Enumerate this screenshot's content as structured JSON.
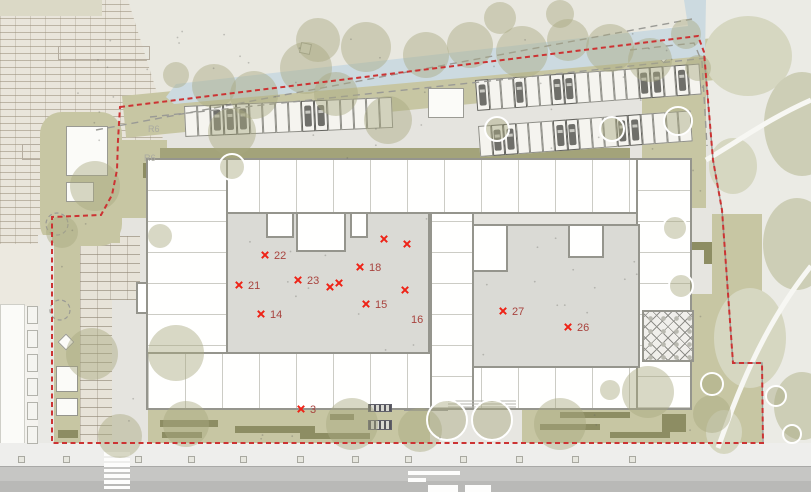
{
  "plan": {
    "room_markers": [
      {
        "label": "22",
        "x": 265,
        "y": 255
      },
      {
        "label": "21",
        "x": 239,
        "y": 285
      },
      {
        "label": "23",
        "x": 298,
        "y": 280
      },
      {
        "label": "18",
        "x": 360,
        "y": 267
      },
      {
        "label": "15",
        "x": 366,
        "y": 304
      },
      {
        "label": "14",
        "x": 261,
        "y": 314
      },
      {
        "label": "27",
        "x": 503,
        "y": 311
      },
      {
        "label": "26",
        "x": 568,
        "y": 327
      },
      {
        "label": "3",
        "x": 301,
        "y": 409
      }
    ],
    "label_only_markers": [
      {
        "label": "16",
        "x": 411,
        "y": 319
      }
    ],
    "unlabeled_markers": [
      {
        "x": 330,
        "y": 287
      },
      {
        "x": 339,
        "y": 283
      },
      {
        "x": 384,
        "y": 239
      },
      {
        "x": 407,
        "y": 244
      },
      {
        "x": 405,
        "y": 290
      }
    ],
    "grid_labels": [
      {
        "text": "R6",
        "x": 148,
        "y": 132
      },
      {
        "text": "R6",
        "x": 144,
        "y": 161
      }
    ]
  },
  "colors": {
    "boundary_red": "#cc3333",
    "marker_x": "#ee2317",
    "marker_label": "#a8433e",
    "site_ground": "#e5e4df",
    "olive_green": "#c7c6a3",
    "dark_olive": "#8d8d63",
    "facade_strip": "#a3a37a",
    "courtyard_gray": "#dadad5",
    "wall_gray": "#95958d",
    "stream_blue": "#ccdae0",
    "park_bg": "#ebebe5",
    "park_blob": "#d6d7c1",
    "park_blob2": "#cdceb6",
    "tree_canopy": "rgba(168,168,128,0.45)",
    "road_gray": "#c6c6c4",
    "road_dark": "#b9b9b7",
    "sidewalk": "#eeeeec",
    "dash_gray": "#9a9a95"
  },
  "trees": {
    "canopies": [
      [
        176,
        75,
        13
      ],
      [
        214,
        86,
        22
      ],
      [
        254,
        95,
        24
      ],
      [
        306,
        68,
        26
      ],
      [
        336,
        94,
        22
      ],
      [
        318,
        40,
        22
      ],
      [
        366,
        47,
        25
      ],
      [
        426,
        55,
        23
      ],
      [
        470,
        45,
        23
      ],
      [
        522,
        52,
        26
      ],
      [
        568,
        40,
        21
      ],
      [
        610,
        48,
        24
      ],
      [
        650,
        60,
        22
      ],
      [
        686,
        34,
        15
      ],
      [
        698,
        68,
        13
      ],
      [
        388,
        120,
        24
      ],
      [
        232,
        132,
        24
      ],
      [
        95,
        186,
        25
      ],
      [
        160,
        236,
        12
      ],
      [
        62,
        232,
        16
      ],
      [
        92,
        354,
        26
      ],
      [
        176,
        353,
        28
      ],
      [
        120,
        436,
        22
      ],
      [
        186,
        424,
        23
      ],
      [
        352,
        424,
        26
      ],
      [
        420,
        430,
        22
      ],
      [
        560,
        424,
        26
      ],
      [
        648,
        392,
        26
      ],
      [
        712,
        414,
        19
      ],
      [
        500,
        18,
        16
      ],
      [
        560,
        14,
        14
      ],
      [
        610,
        390,
        10
      ]
    ],
    "ring_trees": [
      [
        232,
        167,
        13
      ],
      [
        497,
        129,
        12
      ],
      [
        612,
        129,
        12
      ],
      [
        678,
        121,
        14
      ],
      [
        675,
        228,
        12
      ],
      [
        681,
        286,
        12
      ],
      [
        712,
        384,
        11
      ],
      [
        447,
        420,
        20
      ],
      [
        492,
        420,
        20
      ],
      [
        776,
        396,
        10
      ],
      [
        792,
        434,
        9
      ]
    ],
    "dashed_outlines": [
      [
        57,
        224,
        11
      ],
      [
        60,
        310,
        10
      ]
    ]
  },
  "park": {
    "blobs": [
      [
        748,
        56,
        44,
        40
      ],
      [
        802,
        124,
        38,
        52
      ],
      [
        733,
        166,
        24,
        28
      ],
      [
        797,
        244,
        34,
        46
      ],
      [
        750,
        338,
        36,
        50
      ],
      [
        802,
        406,
        28,
        34
      ],
      [
        724,
        432,
        18,
        22
      ]
    ]
  },
  "parking": {
    "groups": [
      {
        "x": 184,
        "y": 106,
        "count": 16,
        "stall_w": 13,
        "stall_h": 31,
        "angle": -2.5,
        "occupied": [
          2,
          3,
          4,
          9,
          10
        ]
      },
      {
        "x": 475,
        "y": 80,
        "count": 18,
        "stall_w": 12.5,
        "stall_h": 31,
        "angle": -4.2,
        "occupied": [
          0,
          3,
          6,
          7,
          13,
          14,
          16
        ]
      },
      {
        "x": 478,
        "y": 126,
        "count": 17,
        "stall_w": 12.5,
        "stall_h": 31,
        "angle": -4.2,
        "occupied": [
          1,
          2,
          6,
          7,
          11,
          12
        ]
      }
    ]
  },
  "boundary_points": "120,107 698,36 704,52 713,160 722,210 733,363 762,363 763,443 52,443 52,217 101,215 112,195 117,170 118,140 120,107"
}
